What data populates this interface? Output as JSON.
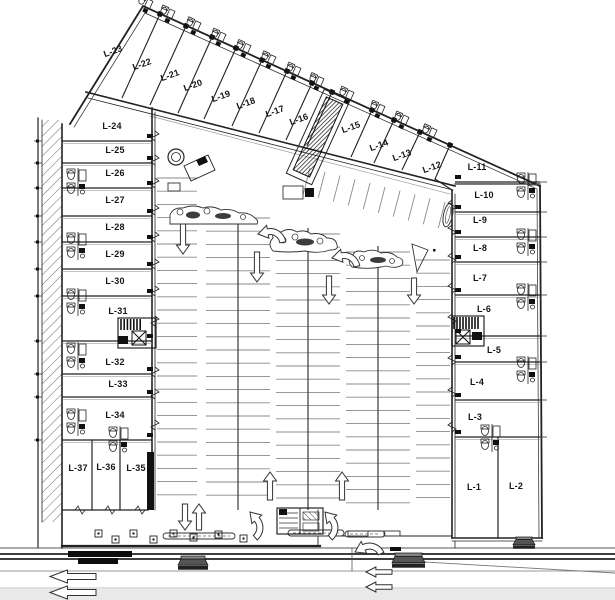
{
  "plan": {
    "type": "architectural-site-plan",
    "units_total": 37,
    "colors": {
      "line": "#222222",
      "line_soft": "#555555",
      "stall": "#8a8a8a",
      "spine": "#3a3a3a",
      "street_band": "#111111",
      "page_band": "#e9e9e9",
      "island_fill": "#ffffff",
      "clump_fill": "#3c3c3c"
    },
    "wings": {
      "top": {
        "label_rotation": -20,
        "lots": [
          {
            "label": "L-23",
            "x": 114,
            "y": 54
          },
          {
            "label": "L-22",
            "x": 143,
            "y": 67
          },
          {
            "label": "L-21",
            "x": 171,
            "y": 78
          },
          {
            "label": "L-20",
            "x": 194,
            "y": 88
          },
          {
            "label": "L-19",
            "x": 222,
            "y": 99
          },
          {
            "label": "L-18",
            "x": 247,
            "y": 106
          },
          {
            "label": "L-17",
            "x": 276,
            "y": 114
          },
          {
            "label": "L-16",
            "x": 300,
            "y": 122
          },
          {
            "label": "L-15",
            "x": 352,
            "y": 130
          },
          {
            "label": "L-14",
            "x": 380,
            "y": 148
          },
          {
            "label": "L-13",
            "x": 403,
            "y": 158
          },
          {
            "label": "L-12",
            "x": 433,
            "y": 170
          },
          {
            "label": "L-11",
            "x": 477,
            "y": 170,
            "rot": 0
          }
        ]
      },
      "left": {
        "lots": [
          {
            "label": "L-24",
            "x": 112,
            "y": 129
          },
          {
            "label": "L-25",
            "x": 115,
            "y": 153
          },
          {
            "label": "L-26",
            "x": 115,
            "y": 176
          },
          {
            "label": "L-27",
            "x": 115,
            "y": 203
          },
          {
            "label": "L-28",
            "x": 115,
            "y": 230
          },
          {
            "label": "L-29",
            "x": 115,
            "y": 257
          },
          {
            "label": "L-30",
            "x": 115,
            "y": 284
          },
          {
            "label": "L-31",
            "x": 118,
            "y": 314
          },
          {
            "label": "L-32",
            "x": 115,
            "y": 365
          },
          {
            "label": "L-33",
            "x": 118,
            "y": 387
          },
          {
            "label": "L-34",
            "x": 115,
            "y": 418
          },
          {
            "label": "L-37",
            "x": 78,
            "y": 471
          },
          {
            "label": "L-36",
            "x": 106,
            "y": 470
          },
          {
            "label": "L-35",
            "x": 136,
            "y": 471
          }
        ]
      },
      "right": {
        "lots": [
          {
            "label": "L-10",
            "x": 484,
            "y": 198
          },
          {
            "label": "L-9",
            "x": 480,
            "y": 223
          },
          {
            "label": "L-8",
            "x": 480,
            "y": 251
          },
          {
            "label": "L-7",
            "x": 480,
            "y": 281
          },
          {
            "label": "L-6",
            "x": 484,
            "y": 312
          },
          {
            "label": "L-5",
            "x": 494,
            "y": 353
          },
          {
            "label": "L-4",
            "x": 477,
            "y": 385
          },
          {
            "label": "L-3",
            "x": 475,
            "y": 420
          },
          {
            "label": "L-1",
            "x": 474,
            "y": 490
          },
          {
            "label": "L-2",
            "x": 516,
            "y": 489
          }
        ]
      }
    },
    "geometry": {
      "boundaries": [
        {
          "n": "top-edge-outer",
          "d": "M70,124 L143,6 L540,186",
          "w": 1.8
        },
        {
          "n": "top-edge-inner",
          "d": "M74,127 L145,13 L537,189",
          "w": 0.7
        },
        {
          "n": "storefront-top-wing",
          "d": "M86,92 L455,186",
          "w": 1.6
        },
        {
          "n": "storefront-top-wing-2",
          "d": "M88,98 L453,190",
          "w": 0.8
        },
        {
          "n": "canopy-top-wing",
          "d": "M150,116 L450,194",
          "w": 0.7,
          "c": "#999999"
        },
        {
          "n": "left-sidewalk-outer",
          "d": "M38,118 L38,548",
          "w": 1.2
        },
        {
          "n": "left-sidewalk-inner",
          "d": "M42,120 L42,522",
          "w": 0.8
        },
        {
          "n": "left-wing-west-wall",
          "d": "M62,124 L62,548",
          "w": 1.6
        },
        {
          "n": "left-wing-east-wall",
          "d": "M152,108 L152,452",
          "w": 1.6
        },
        {
          "n": "left-wing-east-wall-2",
          "d": "M155,112 L155,510",
          "w": 0.8
        },
        {
          "n": "left-wing-bottom",
          "d": "M62,510 L148,510",
          "w": 1.3
        },
        {
          "n": "plaza-bottom",
          "d": "M62,546 L320,546",
          "w": 2.2
        },
        {
          "n": "plaza-right-edge",
          "d": "M318,510 L318,546",
          "w": 0.9
        },
        {
          "n": "right-wing-west-wall",
          "d": "M452,190 L452,538",
          "w": 1.6
        },
        {
          "n": "right-wing-west-wall-2",
          "d": "M455,194 L455,538",
          "w": 0.8
        },
        {
          "n": "right-wing-east-wall",
          "d": "M540,186 L542,538",
          "w": 1.8
        },
        {
          "n": "right-wing-east-wall-2",
          "d": "M537,190 L539,538",
          "w": 0.7
        },
        {
          "n": "right-wing-bottom",
          "d": "M452,538 L542,538",
          "w": 1.6
        },
        {
          "n": "right-wing-bottom-2",
          "d": "M452,541 L542,541",
          "w": 0.8
        },
        {
          "n": "lot11-bottom-line",
          "d": "M455,184 L540,184",
          "w": 1.2
        },
        {
          "n": "wing-connector",
          "d": "M435,179 L452,190",
          "w": 1.2
        },
        {
          "n": "lot1-lot2-divider",
          "d": "M498,437 L498,538",
          "w": 1.2
        },
        {
          "n": "lot37-divider",
          "d": "M92,440 L92,510",
          "w": 1.2
        },
        {
          "n": "lot36-divider",
          "d": "M120,440 L120,510",
          "w": 1.2
        },
        {
          "n": "curb-bottom-center",
          "d": "M330,536 L452,536",
          "w": 0.9
        },
        {
          "n": "street-line-1",
          "d": "M0,548 L615,548",
          "w": 1,
          "c": "#555555"
        },
        {
          "n": "street-line-2",
          "d": "M0,554 L615,554",
          "w": 1.8
        },
        {
          "n": "street-line-3",
          "d": "M0,559 L615,559",
          "w": 1.8
        },
        {
          "n": "street-line-4",
          "d": "M0,571 L615,571",
          "w": 0.9,
          "c": "#999999"
        },
        {
          "n": "curb-diagonal",
          "d": "M424,562 L615,573",
          "w": 0.9,
          "c": "#777777"
        },
        {
          "n": "page-edge-line",
          "d": "M0,588 L615,588",
          "w": 0.8,
          "c": "#aaaaaa"
        },
        {
          "n": "entry-stub",
          "d": "M352,548 L352,571",
          "w": 0.8,
          "c": "#555555"
        },
        {
          "n": "right-entry-stub",
          "d": "M455,541 L455,548",
          "w": 0.8
        }
      ],
      "top_dividers": [
        [
          160,
          14,
          122,
          98
        ],
        [
          186,
          26,
          150,
          105
        ],
        [
          212,
          37,
          178,
          113
        ],
        [
          236,
          48,
          204,
          119
        ],
        [
          262,
          60,
          232,
          126
        ],
        [
          287,
          71,
          259,
          133
        ],
        [
          312,
          83,
          286,
          140
        ],
        [
          332,
          92,
          307,
          146
        ],
        [
          372,
          110,
          351,
          157
        ],
        [
          394,
          120,
          374,
          163
        ],
        [
          420,
          132,
          402,
          170
        ],
        [
          450,
          145,
          435,
          179
        ]
      ],
      "top_fixture_mids": [
        151,
        173,
        199,
        224,
        249,
        274,
        299,
        322,
        352,
        383,
        407,
        435
      ],
      "left_dividers": [
        141,
        163,
        188,
        216,
        242,
        269,
        296,
        341,
        374,
        397,
        440
      ],
      "right_dividers": [
        182,
        212,
        237,
        262,
        295,
        336,
        362,
        400,
        437
      ],
      "parking_stacks": [
        {
          "x1": 157,
          "x2": 197,
          "y1": 178,
          "y2": 506,
          "step": 13.2
        },
        {
          "x1": 206,
          "x2": 270,
          "y1": 218,
          "y2": 506,
          "step": 13.2,
          "spine": 238
        },
        {
          "x1": 276,
          "x2": 340,
          "y1": 234,
          "y2": 506,
          "step": 13.2,
          "spine": 308
        },
        {
          "x1": 346,
          "x2": 410,
          "y1": 252,
          "y2": 506,
          "step": 13.2,
          "spine": 378
        },
        {
          "x1": 416,
          "x2": 450,
          "y1": 260,
          "y2": 506,
          "step": 13.2
        }
      ],
      "angled_ticks": {
        "x1": 310,
        "y1": 168,
        "x2": 445,
        "y2": 202,
        "count": 10,
        "dx": -6.7,
        "dy": 26
      },
      "arrows": [
        {
          "t": "down",
          "x": 183,
          "y": 224,
          "len": 30
        },
        {
          "t": "down",
          "x": 257,
          "y": 252,
          "len": 30
        },
        {
          "t": "down",
          "x": 329,
          "y": 276,
          "len": 28
        },
        {
          "t": "down",
          "x": 414,
          "y": 278,
          "len": 26
        },
        {
          "t": "down",
          "x": 185,
          "y": 504,
          "len": 26
        },
        {
          "t": "up",
          "x": 199,
          "y": 504,
          "len": 26
        },
        {
          "t": "up",
          "x": 270,
          "y": 472,
          "len": 28
        },
        {
          "t": "up",
          "x": 342,
          "y": 472,
          "len": 28
        }
      ],
      "curved_arrows": [
        {
          "x": 258,
          "y": 234,
          "rot": -10
        },
        {
          "x": 332,
          "y": 258,
          "rot": -10
        },
        {
          "x": 250,
          "y": 512,
          "rot": 50
        },
        {
          "x": 325,
          "y": 512,
          "rot": 50
        },
        {
          "x": 355,
          "y": 552,
          "rot": -25
        }
      ],
      "street_arrows": [
        {
          "x": 50,
          "y": 570,
          "w": 46,
          "h": 13
        },
        {
          "x": 50,
          "y": 586,
          "w": 46,
          "h": 13
        },
        {
          "x": 366,
          "y": 567,
          "w": 26,
          "h": 10
        },
        {
          "x": 366,
          "y": 582,
          "w": 26,
          "h": 10
        }
      ],
      "restrooms": {
        "left_wall_x": 66,
        "left_ys": [
          168,
          232,
          288,
          342,
          408
        ],
        "right_wall_x": 516,
        "right_ys": [
          172,
          228,
          283,
          356
        ],
        "extra": [
          [
            108,
            426
          ],
          [
            480,
            424
          ]
        ]
      },
      "islands": [
        {
          "d": "M170,224 L170,215 Q173,207 183,208 Q193,204 203,208 Q212,205 221,210 Q231,208 239,213 Q249,212 255,218 Q259,221 257,224 Z",
          "clumps": [
            [
              193,
              215,
              7,
              3.5
            ],
            [
              223,
              216,
              8,
              3
            ]
          ],
          "bushes": [
            [
              180,
              212,
              3
            ],
            [
              207,
              211,
              3
            ],
            [
              243,
              217,
              2.5
            ]
          ]
        },
        {
          "d": "M273,251 Q267,244 273,238 Q271,231 281,232 Q289,227 297,232 Q305,229 311,234 Q321,232 327,238 Q336,238 337,245 Q339,250 330,250 Q318,254 305,251 Q288,253 273,251 Z",
          "clumps": [
            [
              305,
              242,
              9,
              3.5
            ]
          ],
          "bushes": [
            [
              283,
              240,
              3
            ],
            [
              295,
              237,
              3
            ],
            [
              320,
              241,
              3
            ]
          ]
        },
        {
          "d": "M352,267 Q346,260 353,255 Q355,249 364,252 Q373,248 381,253 Q391,251 397,257 Q405,259 402,265 Q396,269 386,266 Q370,270 352,267 Z",
          "clumps": [
            [
              378,
              260,
              8,
              3
            ]
          ],
          "bushes": [
            [
              362,
              258,
              2.5
            ],
            [
              392,
              261,
              2.5
            ]
          ]
        }
      ],
      "bottom_strips": [
        [
          163,
          533,
          72,
          6
        ],
        [
          288,
          530,
          56,
          6
        ],
        [
          345,
          531,
          40,
          6
        ]
      ],
      "plaza_squares": [
        [
          95,
          530
        ],
        [
          112,
          536
        ],
        [
          130,
          530
        ],
        [
          150,
          536
        ],
        [
          170,
          530
        ],
        [
          190,
          534
        ],
        [
          215,
          531
        ],
        [
          240,
          535
        ]
      ],
      "street_bars": [
        [
          68,
          551,
          64,
          6
        ],
        [
          78,
          558,
          40,
          6
        ],
        [
          390,
          547,
          11,
          4
        ]
      ],
      "spools": [
        [
          178,
          556,
          30,
          14
        ],
        [
          392,
          553,
          33,
          15
        ],
        [
          513,
          537,
          22,
          12
        ]
      ],
      "outline_rects": [
        [
          283,
          186,
          20,
          13
        ],
        [
          348,
          531,
          20,
          5
        ],
        [
          384,
          531,
          16,
          5
        ],
        [
          168,
          183,
          12,
          8
        ]
      ],
      "black_rects": [
        [
          147,
          452,
          7,
          58
        ],
        [
          305,
          188,
          9,
          9
        ]
      ],
      "core_top": {
        "inner": "M326.4,96.9 L342.8,104.3 L309.6,177.1 L293.2,169.7 Z",
        "outer": "M324.3,89.3 L349.8,100.9 L311.7,184.7 L286.3,173.1 Z"
      },
      "core_left": {
        "x": 118,
        "y": 318,
        "w": 38,
        "h": 30
      },
      "core_right": {
        "x": 452,
        "y": 316,
        "w": 32,
        "h": 30
      },
      "circle_feature": {
        "cx": 176,
        "cy": 157,
        "r1": 8,
        "r2": 4.5,
        "rect": "M184,166 l24,-11 l7,15 l-24,11 z",
        "tab": "M196,160 l9,-4 l3,6 l-9,4 z"
      },
      "flag_marker": {
        "d": "M412,244 L428,250 L417,272 Z",
        "dot": [
          433,
          249
        ]
      },
      "guard_structure": {
        "x": 277,
        "y": 508,
        "w": 46,
        "h": 26
      },
      "oval_island": {
        "cx": 448,
        "cy": 215,
        "rx": 4.5,
        "ry": 12,
        "rot": 12
      }
    }
  }
}
